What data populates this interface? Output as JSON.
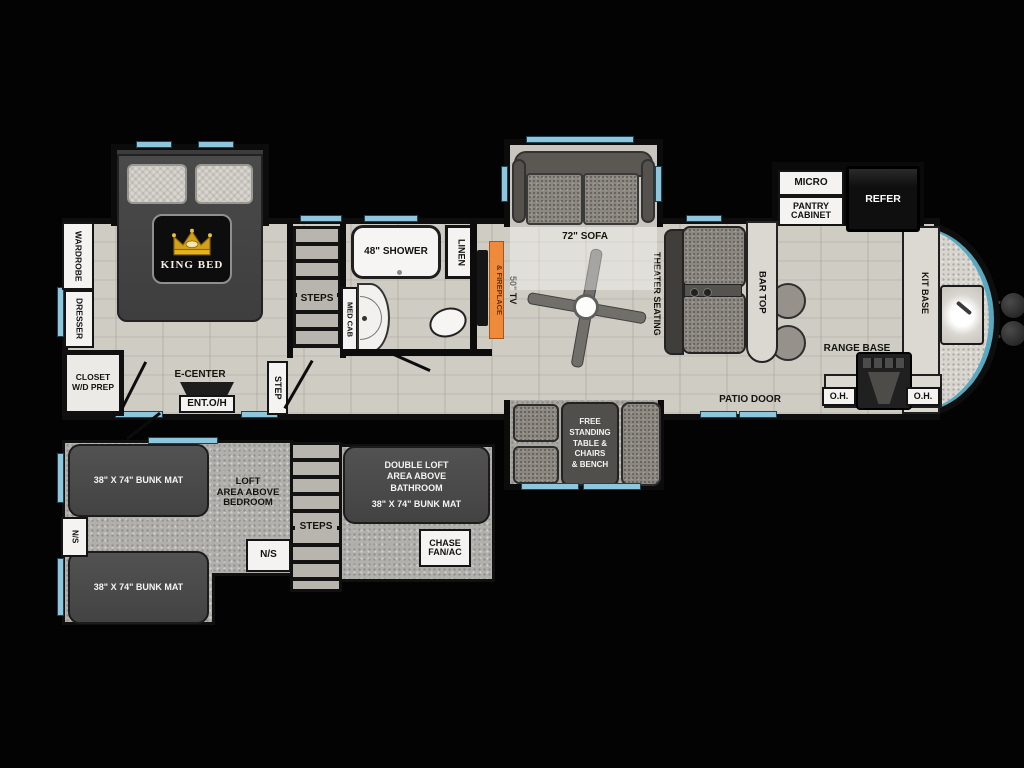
{
  "colors": {
    "background": "#000000",
    "floor_wood": "#cfccc4",
    "floor_loft": "#b2b0ac",
    "wall": "#0c0c0c",
    "window_accent": "#8ec6dd",
    "front_cap_accent": "#4aa3c0",
    "furniture_dark": "#4a4a4a",
    "fireplace_orange": "#ef8a3a",
    "label_box": "#f4f3f1",
    "crown_gold": "#d4a017"
  },
  "bedroom": {
    "wardrobe": "WARDROBE",
    "dresser": "DRESSER",
    "closet": "CLOSET\nW/D PREP",
    "king_bed": "KING BED",
    "steps": "STEPS",
    "step": "STEP",
    "e_center": "E-CENTER",
    "ent_oh": "ENT.O/H"
  },
  "bathroom": {
    "shower": "48\" SHOWER",
    "linen": "LINEN",
    "med_cab": "MED CAB"
  },
  "living": {
    "tv": "50\" TV",
    "fireplace": "& FIREPLACE",
    "sofa": "72\" SOFA",
    "theater": "THEATER SEATING",
    "bar_top": "BAR TOP",
    "patio_door": "PATIO DOOR"
  },
  "kitchen": {
    "micro": "MICRO",
    "pantry": "PANTRY\nCABINET",
    "refer": "REFER",
    "kit_base": "KIT BASE",
    "range_base": "RANGE BASE",
    "oh_left": "O.H.",
    "oh_right": "O.H."
  },
  "dinette": {
    "table": "FREE\nSTANDING\nTABLE &\nCHAIRS\n& BENCH"
  },
  "loft": {
    "bunk_top": "38\" X 74\" BUNK MAT",
    "bunk_bottom": "38\" X 74\" BUNK MAT",
    "ns_left": "N/S",
    "ns_mid": "N/S",
    "area": "LOFT\nAREA ABOVE\nBEDROOM",
    "steps": "STEPS",
    "double_loft": "DOUBLE LOFT\nAREA ABOVE\nBATHROOM",
    "double_bunk": "38\" X 74\" BUNK MAT",
    "chase": "CHASE\nFAN/AC"
  }
}
